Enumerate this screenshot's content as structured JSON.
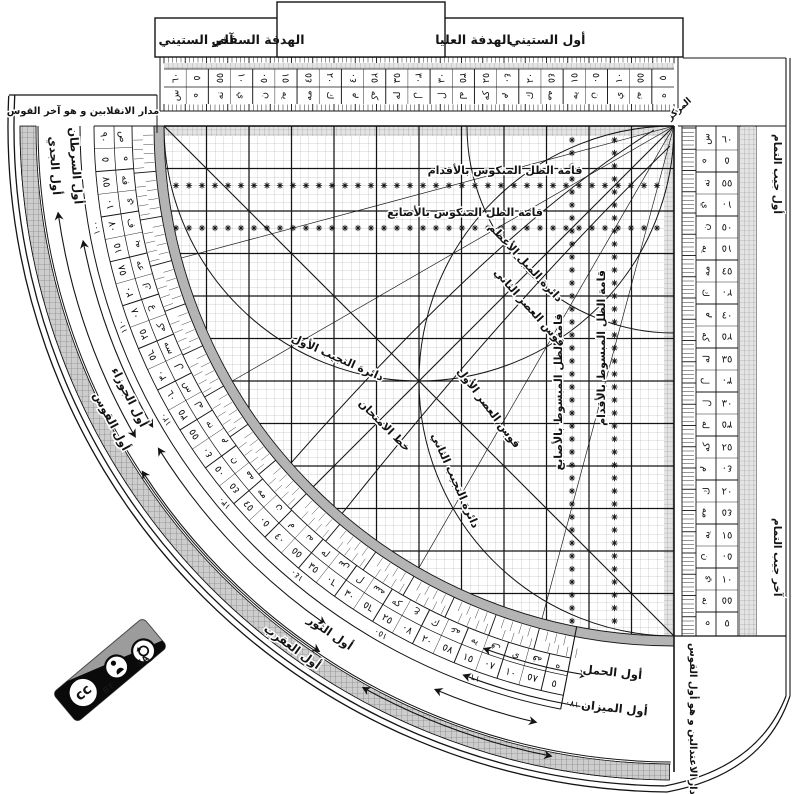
{
  "header": {
    "first_sixty": "أول الستيني",
    "upper_sight": "الهدفة العليا",
    "lower_sight": "الهدفة السفلي",
    "last_sixty": "آخر الستيني"
  },
  "margins": {
    "solstice_line": "مدار الانقلابين و هو آخر القوس",
    "equinox_line": "مدار الاعتدالين و هو أول القوس",
    "center_point": "المركز",
    "cosine_first": "أول جيب التمام",
    "cosine_last": "آخر جيب التمام"
  },
  "grid_labels": {
    "reversed_shadow_feet": "قامة الظل المنكوس بالأقدام",
    "reversed_shadow_digits": "قامة الظل المنكوس بالأصابع",
    "flat_shadow_digits": "قامة الظل المبسوط بالأصابع",
    "flat_shadow_feet": "قامة الظل المبسوط بالأقدام",
    "max_declination": "دائرة الميل الأعظم",
    "second_asr": "قوس العصر الثاني",
    "first_asr": "قوس العصر الأول",
    "first_sine_circle": "دائرة التجيب الأول",
    "second_sine_circle": "دائرة التجيب الثاني",
    "test_line": "خط الامتحان"
  },
  "zodiac": {
    "capricorn": "أول الجدي",
    "cancer": "أول السرطان",
    "gemini": "أول الجوزاء",
    "sagittarius": "أول القوس",
    "taurus": "أول الثور",
    "scorpio": "أول العقرب",
    "aries": "أول الحمل",
    "libra": "أول الميزان"
  },
  "badge": {
    "cc": "cc",
    "by": "BY",
    "sa": "SA"
  },
  "scales": {
    "sixty": [
      {
        "n": "٦٠",
        "a": "س",
        "f": 0
      },
      {
        "n": "٥",
        "a": "ه",
        "f": 1
      },
      {
        "n": "٥٥",
        "a": "نه",
        "f": 0
      },
      {
        "n": "١٠",
        "a": "ي",
        "f": 1
      },
      {
        "n": "٥٠",
        "a": "ن",
        "f": 0
      },
      {
        "n": "١٥",
        "a": "يه",
        "f": 1
      },
      {
        "n": "٤٥",
        "a": "مه",
        "f": 0
      },
      {
        "n": "٢٠",
        "a": "ك",
        "f": 1
      },
      {
        "n": "٤٠",
        "a": "م",
        "f": 0
      },
      {
        "n": "٢٥",
        "a": "كه",
        "f": 1
      },
      {
        "n": "٣٥",
        "a": "له",
        "f": 0
      },
      {
        "n": "٣٠",
        "a": "ل",
        "f": 1
      },
      {
        "n": "٣٠",
        "a": "ل",
        "f": 0
      },
      {
        "n": "٣٥",
        "a": "له",
        "f": 1
      },
      {
        "n": "٢٥",
        "a": "كه",
        "f": 0
      },
      {
        "n": "٤٠",
        "a": "م",
        "f": 1
      },
      {
        "n": "٢٠",
        "a": "ك",
        "f": 0
      },
      {
        "n": "٤٥",
        "a": "مه",
        "f": 1
      },
      {
        "n": "١٥",
        "a": "يه",
        "f": 0
      },
      {
        "n": "٥٠",
        "a": "ن",
        "f": 1
      },
      {
        "n": "١٠",
        "a": "ي",
        "f": 0
      },
      {
        "n": "٥٥",
        "a": "نه",
        "f": 1
      },
      {
        "n": "٥",
        "a": "ه",
        "f": 0
      }
    ],
    "arc": [
      {
        "n": "٩٠",
        "a": "ص",
        "f": 0
      },
      {
        "n": "٥",
        "a": "ه",
        "f": 1
      },
      {
        "n": "٨٥",
        "a": "فه",
        "f": 0
      },
      {
        "n": "١٠",
        "a": "ي",
        "f": 1
      },
      {
        "n": "٨٠",
        "a": "ف",
        "f": 0
      },
      {
        "n": "١٥",
        "a": "يه",
        "f": 1
      },
      {
        "n": "٧٥",
        "a": "عه",
        "f": 0
      },
      {
        "n": "٢٠",
        "a": "ك",
        "f": 1
      },
      {
        "n": "٧٠",
        "a": "ع",
        "f": 0
      },
      {
        "n": "٢٥",
        "a": "كه",
        "f": 1
      },
      {
        "n": "٦٥",
        "a": "سه",
        "f": 0
      },
      {
        "n": "٣٠",
        "a": "ل",
        "f": 1
      },
      {
        "n": "٦٠",
        "a": "س",
        "f": 0
      },
      {
        "n": "٣٥",
        "a": "له",
        "f": 1
      },
      {
        "n": "٥٥",
        "a": "نه",
        "f": 0
      },
      {
        "n": "٤٠",
        "a": "م",
        "f": 1
      },
      {
        "n": "٥٠",
        "a": "ن",
        "f": 0
      },
      {
        "n": "٤٥",
        "a": "مه",
        "f": 1
      },
      {
        "n": "٤٥",
        "a": "مه",
        "f": 0
      },
      {
        "n": "٥٠",
        "a": "ن",
        "f": 1
      },
      {
        "n": "٤٠",
        "a": "م",
        "f": 0
      },
      {
        "n": "٥٥",
        "a": "نه",
        "f": 1
      },
      {
        "n": "٣٥",
        "a": "له",
        "f": 0
      },
      {
        "n": "٦٠",
        "a": "س",
        "f": 1
      },
      {
        "n": "٣٠",
        "a": "ل",
        "f": 0
      },
      {
        "n": "٦٥",
        "a": "سه",
        "f": 1
      },
      {
        "n": "٢٥",
        "a": "كه",
        "f": 0
      },
      {
        "n": "٧٠",
        "a": "ع",
        "f": 1
      },
      {
        "n": "٢٠",
        "a": "ك",
        "f": 0
      },
      {
        "n": "٧٥",
        "a": "عه",
        "f": 1
      },
      {
        "n": "١٥",
        "a": "يه",
        "f": 0
      },
      {
        "n": "٨٠",
        "a": "ف",
        "f": 1
      },
      {
        "n": "١٠",
        "a": "ي",
        "f": 0
      },
      {
        "n": "٨٥",
        "a": "فه",
        "f": 1
      },
      {
        "n": "٥",
        "a": "ه",
        "f": 0
      }
    ],
    "secondary": [
      "١٠٠",
      "١١٠",
      "١٢٠",
      "١٣٠",
      "١٤٠",
      "١٥٠",
      "١٦٠",
      "١٧٠"
    ]
  },
  "colors": {
    "ink": "#141414",
    "grid_line": "#808080",
    "rim": "#b4b4b4",
    "badge_grey": "#9c9c9c"
  }
}
